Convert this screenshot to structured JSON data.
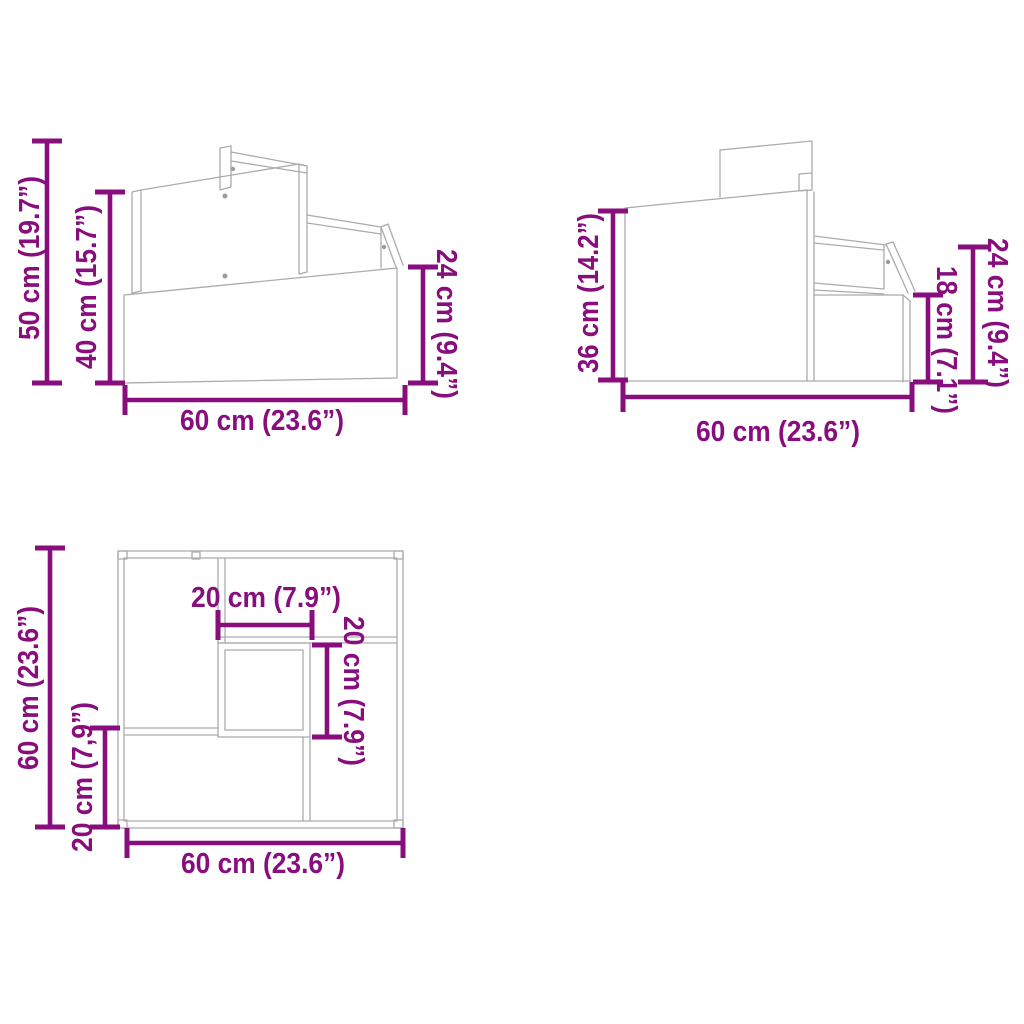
{
  "image": {
    "description": "Technical dimension diagram of a two-step stool shown in three line-drawing views",
    "background_color": "#ffffff",
    "line_art_color": "#ababab",
    "dimension_color": "#880e7e"
  },
  "views": {
    "side_a": {
      "name": "side view with step heights",
      "dims": {
        "total_height": "50 cm (19.7”)",
        "panel_height": "40 cm (15.7”)",
        "step_height": "24 cm (9.4”)",
        "width": "60 cm (23.6”)"
      }
    },
    "side_b": {
      "name": "opposite side view",
      "dims": {
        "total_height": "36 cm (14.2”)",
        "step_height": "18 cm (7.1”)",
        "rail_height": "24 cm (9.4”)",
        "width": "60 cm (23.6”)"
      }
    },
    "top": {
      "name": "top view",
      "dims": {
        "depth_total": "60 cm (23.6”)",
        "lower_step_depth": "20 cm (7,9”)",
        "opening_width": "20 cm (7.9”)",
        "opening_depth": "20 cm (7.9”)",
        "width": "60 cm (23.6”)"
      }
    }
  }
}
